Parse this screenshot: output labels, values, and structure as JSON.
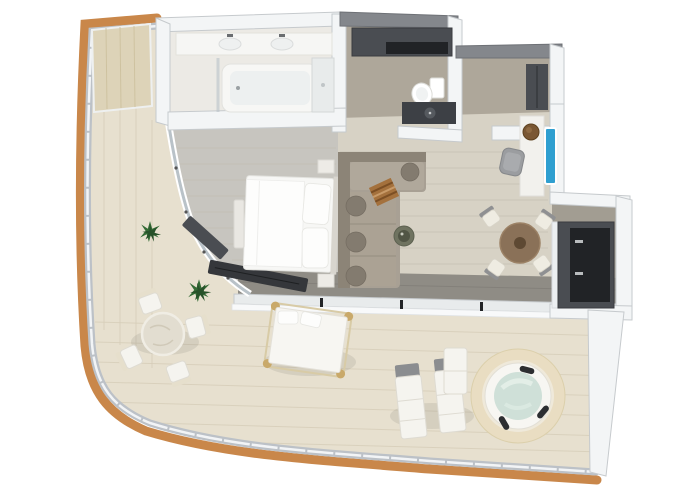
{
  "meta": {
    "scene": "Isometric 3D floor plan of a one-bedroom suite with wrap-around terrace, no text labels visible"
  },
  "palette": {
    "bg": "#ffffff",
    "deck": "#e7e0cf",
    "deck_line": "#d6cdb8",
    "trim_wood": "#c9874a",
    "railing": "#bcc1c7",
    "railing_cap": "#f2f4f6",
    "wall": "#f3f5f6",
    "wall_cap": "#c6cacd",
    "wall_dark": "#84878c",
    "floor_bath": "#eceae5",
    "floor_taupe": "#aea79a",
    "floor_bed": "#c7c5bf",
    "floor_living": "#d7d2c5",
    "floor_plank": "#c2bdb0",
    "floor_walkway": "#8f8c85",
    "floor_kitchenzone": "#a29d92",
    "dark_unit": "#4a4d52",
    "dark_inner": "#212326",
    "white_furn": "#f5f4ef",
    "sofa": "#a8a094",
    "sofa_back": "#8c8477",
    "sofa_cushion": "#837b6f",
    "bed_white": "#f7f7f5",
    "pillow": "#fdfdfc",
    "table_brown": "#8a7158",
    "table_brown_dark": "#5e4933",
    "chair_seat": "#efece2",
    "chair_back": "#8f9092",
    "coffee_table": "#6f7360",
    "stool_brown": "#7a5733",
    "tv_blue": "#2f9fd0",
    "glass": "#b9c2c8",
    "water": "#cfe0d8",
    "tub_surround": "#e9ddc2",
    "tub_rim": "#f7f6f2",
    "pad_dark": "#2c2e31",
    "plant": "#336b35",
    "plant_dark": "#27522a",
    "panel_wood": "#ddd3b8",
    "panel_grain": "#cdc19e",
    "throw": "#a4713d"
  },
  "labels": {
    "plan": "3D floor plan of suite with terrace",
    "terrace": "Wrap-around terrace",
    "bedroom": "Bedroom",
    "living_room": "Living room",
    "bathroom": "Bathroom",
    "walk_in_closet": "Walk-in closet and WC",
    "entry_hall": "Entry hall",
    "desk_nook": "Desk nook",
    "kitchenette": "Kitchenette bar",
    "hot_tub": "Round hot tub",
    "sun_loungers": "Two sun loungers",
    "daybed": "Outdoor day bed",
    "outdoor_dining": "Outdoor dining table with four chairs",
    "indoor_dining": "Round dining table with four chairs",
    "sofa": "L-shaped sofa",
    "double_bed": "Double bed",
    "bathtub": "Bathtub",
    "toilet": "Toilet",
    "wardrobe": "Wardrobe",
    "railing": "Curved glass railing with wood trim"
  }
}
